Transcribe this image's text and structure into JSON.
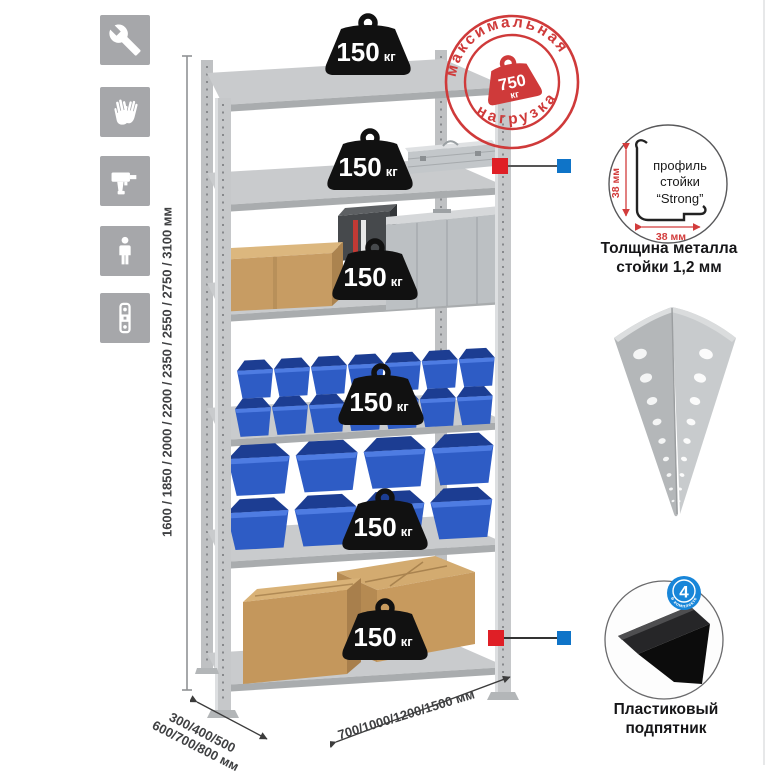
{
  "sidebar": {
    "icons": [
      {
        "name": "wrench"
      },
      {
        "name": "gloves"
      },
      {
        "name": "drill"
      },
      {
        "name": "person"
      },
      {
        "name": "level"
      }
    ]
  },
  "dimensions": {
    "height_label": "1600 / 1850 / 2000 / 2200 / 2350 / 2550 / 2750 / 3100 мм",
    "depth_label_line1": "300/400/500",
    "depth_label_line2": "600/700/800 мм",
    "width_label": "700/1000/1200/1500 мм"
  },
  "max_load_stamp": {
    "arc_top": "максимальная",
    "arc_bottom": "нагрузка",
    "value": "750",
    "unit": "кг"
  },
  "shelves": [
    {
      "load_value": "150",
      "load_unit": "кг",
      "contents": []
    },
    {
      "load_value": "150",
      "load_unit": "кг",
      "contents": [
        "aluminum-case"
      ]
    },
    {
      "load_value": "150",
      "load_unit": "кг",
      "contents": [
        "cardboard-box",
        "metal-canister",
        "aluminum-case"
      ]
    },
    {
      "load_value": "150",
      "load_unit": "кг",
      "contents": [
        "blue-stacking-bins"
      ]
    },
    {
      "load_value": "150",
      "load_unit": "кг",
      "contents": [
        "blue-stacking-bins-large"
      ]
    },
    {
      "load_value": "150",
      "load_unit": "кг",
      "contents": [
        "cardboard-boxes"
      ]
    }
  ],
  "details": {
    "profile": {
      "label_line1": "профиль",
      "label_line2": "стойки",
      "label_line3": "“Strong”",
      "dim_vertical": "38 мм",
      "dim_horizontal": "38 мм",
      "caption_line1": "Толщина металла",
      "caption_line2": "стойки 1,2 мм"
    },
    "post": {
      "name": "perforated-angle-post"
    },
    "foot": {
      "badge_value": "4",
      "badge_arc": "в комплекте",
      "caption_line1": "Пластиковый",
      "caption_line2": "подпятник"
    }
  },
  "colors": {
    "accent_red": "#df1f26",
    "accent_blue": "#0f74c8",
    "stamp_red": "#cf3a3a",
    "bin_blue": "#2e5cc5",
    "metal_gray": "#c6c8ca",
    "icon_gray": "#a6a7aa"
  }
}
